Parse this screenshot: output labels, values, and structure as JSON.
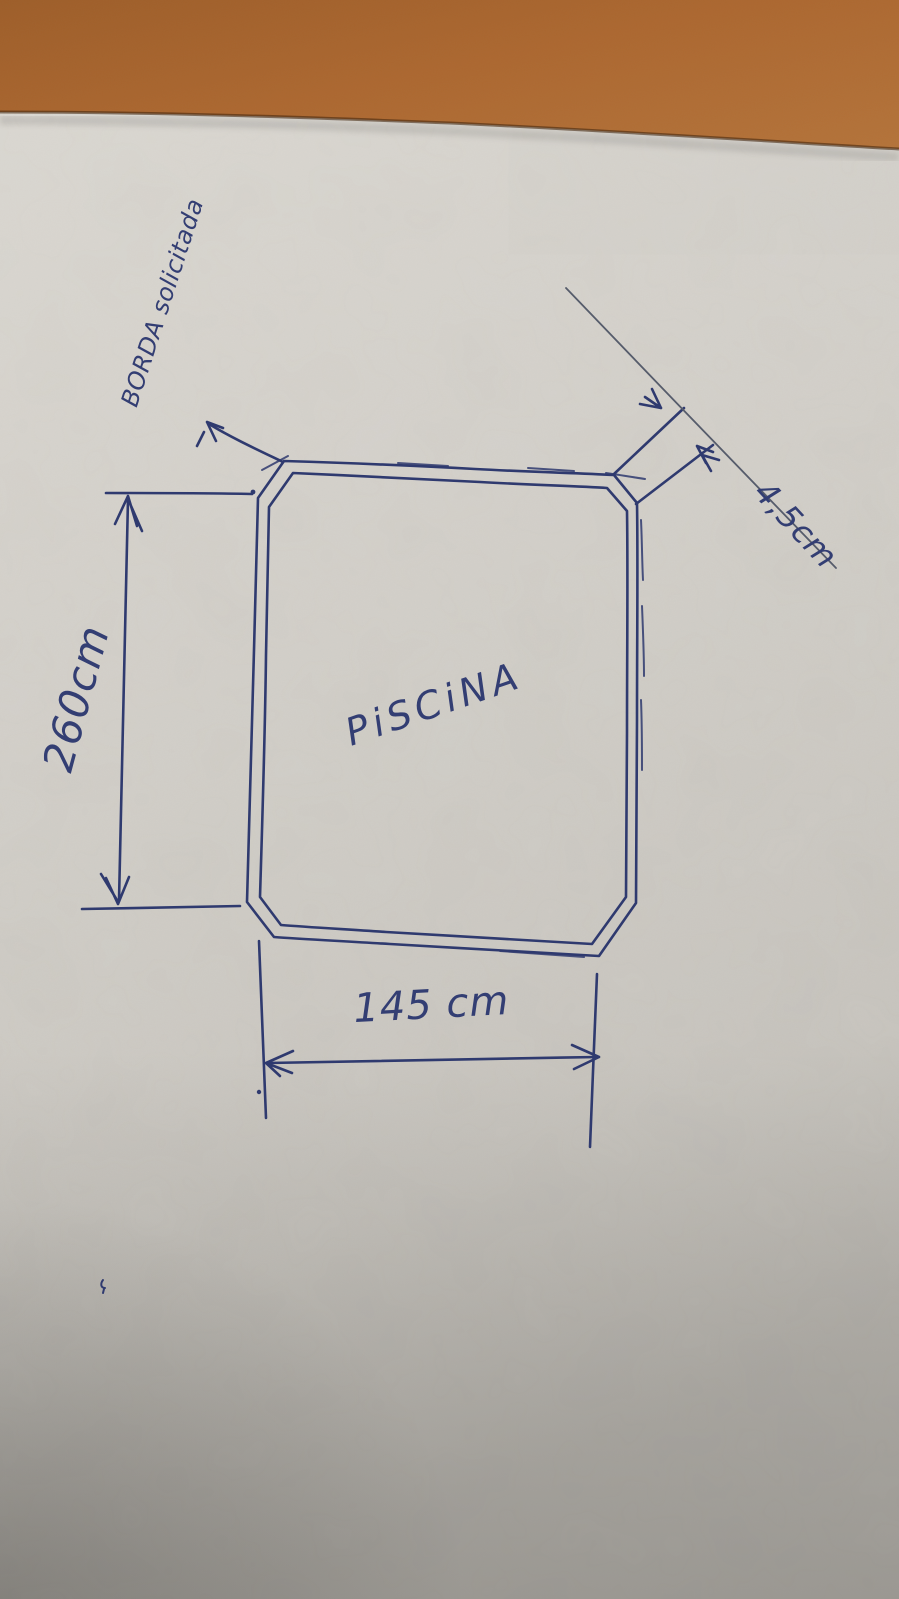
{
  "sketch": {
    "pool_label": "PiSCiNA",
    "border_note": "BORDA solicitada",
    "dim_height": "260cm",
    "dim_width": "145 cm",
    "dim_border": "4,5cm",
    "colors": {
      "ink": "#333e73",
      "pencil_line": "#5a6070",
      "paper": "#d5d2cc",
      "table_background": "#b06a33"
    }
  }
}
